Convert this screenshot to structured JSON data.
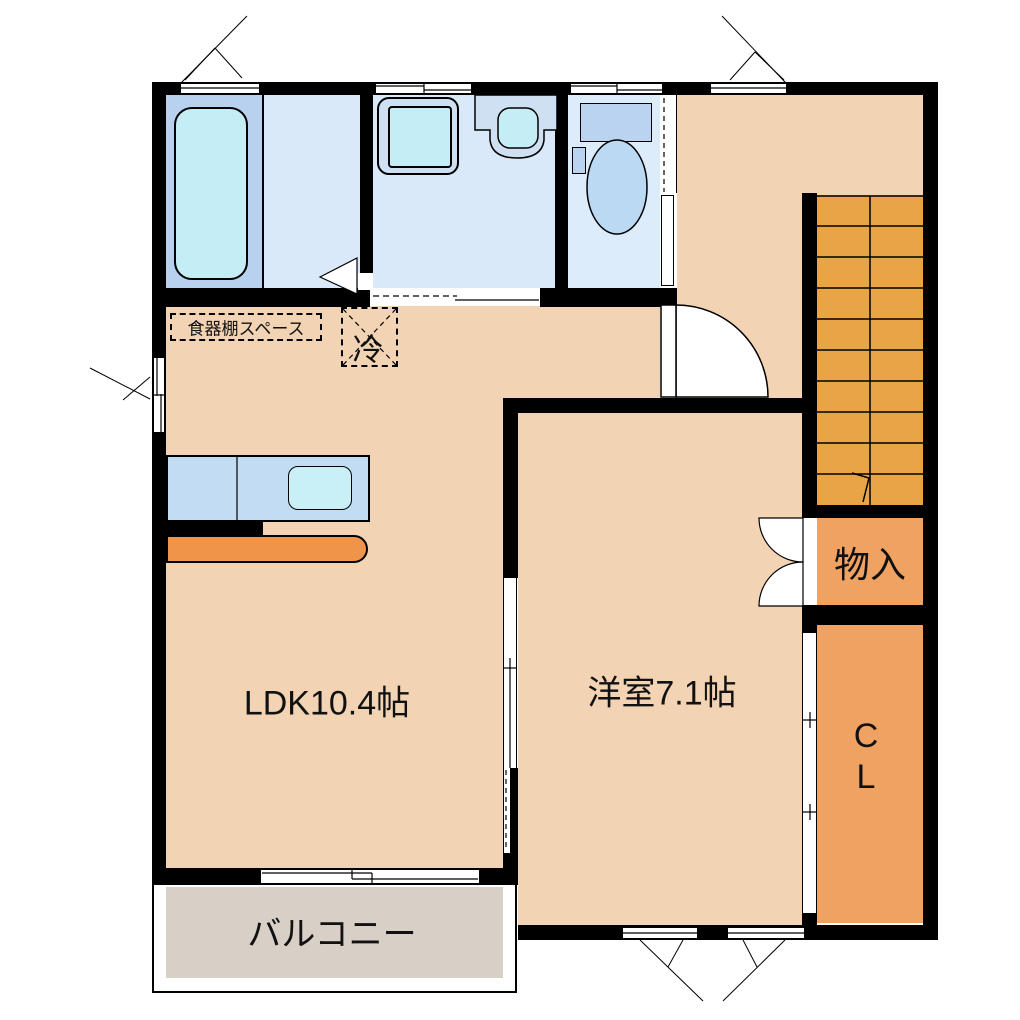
{
  "rooms": {
    "ldk": "LDK10.4帖",
    "western": "洋室7.1帖",
    "balcony": "バルコニー",
    "storage": "物入",
    "closet_l1": "C",
    "closet_l2": "L"
  },
  "kitchen": {
    "cupboard": "食器棚スペース",
    "fridge": "冷"
  },
  "colors": {
    "floor_peach": "#f2d3b3",
    "stairs_orange": "#e9a445",
    "storage_orange": "#f0a262",
    "bathroom_blue": "#b7d1ef",
    "washroom_blue": "#d9e9fa",
    "toilet_blue": "#ddecfb",
    "fixture_blue": "#cfe0f2",
    "fixture_cyan": "#c5edf6",
    "kitchen_counter_blue": "#c2dcf4",
    "kitchen_counter_orange": "#f0944a",
    "balcony_gray": "#d8d0c7",
    "wall_black": "#000000"
  }
}
